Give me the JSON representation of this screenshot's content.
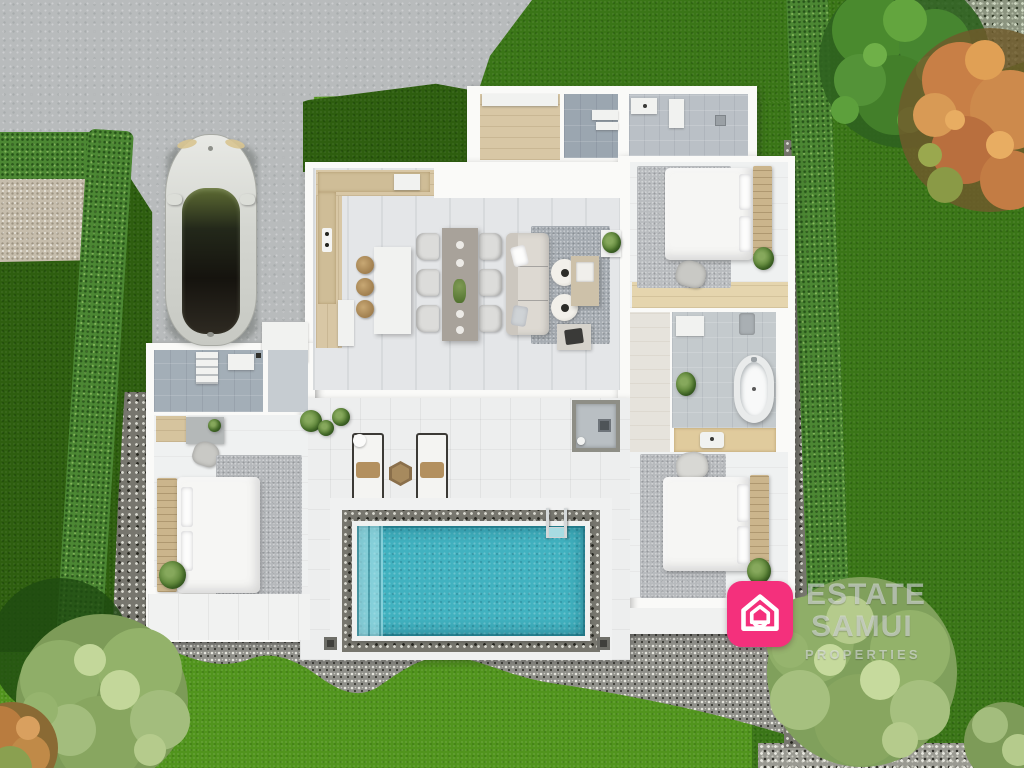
{
  "watermark": {
    "line1": "ESTATE",
    "line2": "SAMUI",
    "line3": "PROPERTIES"
  },
  "brand": {
    "logo_icon": "house-icon",
    "logo_color": "#f4307c",
    "text_color": "rgba(226,230,232,0.58)"
  },
  "palette": {
    "driveway_concrete": "#b8bbbc",
    "lawn_bright": "#51941d",
    "lawn_dark": "#3a7517",
    "hedge_green": "#4c8733",
    "pebble_gravel": "#8e8e86",
    "beige_gravel": "#c6bdac",
    "house_wall": "#fafaf8",
    "wood_floor": "#d8c7a5",
    "pool_water": "#41b2c0",
    "rug_gray": "#b2b6b9",
    "autumn_tree": "#c87f46"
  }
}
